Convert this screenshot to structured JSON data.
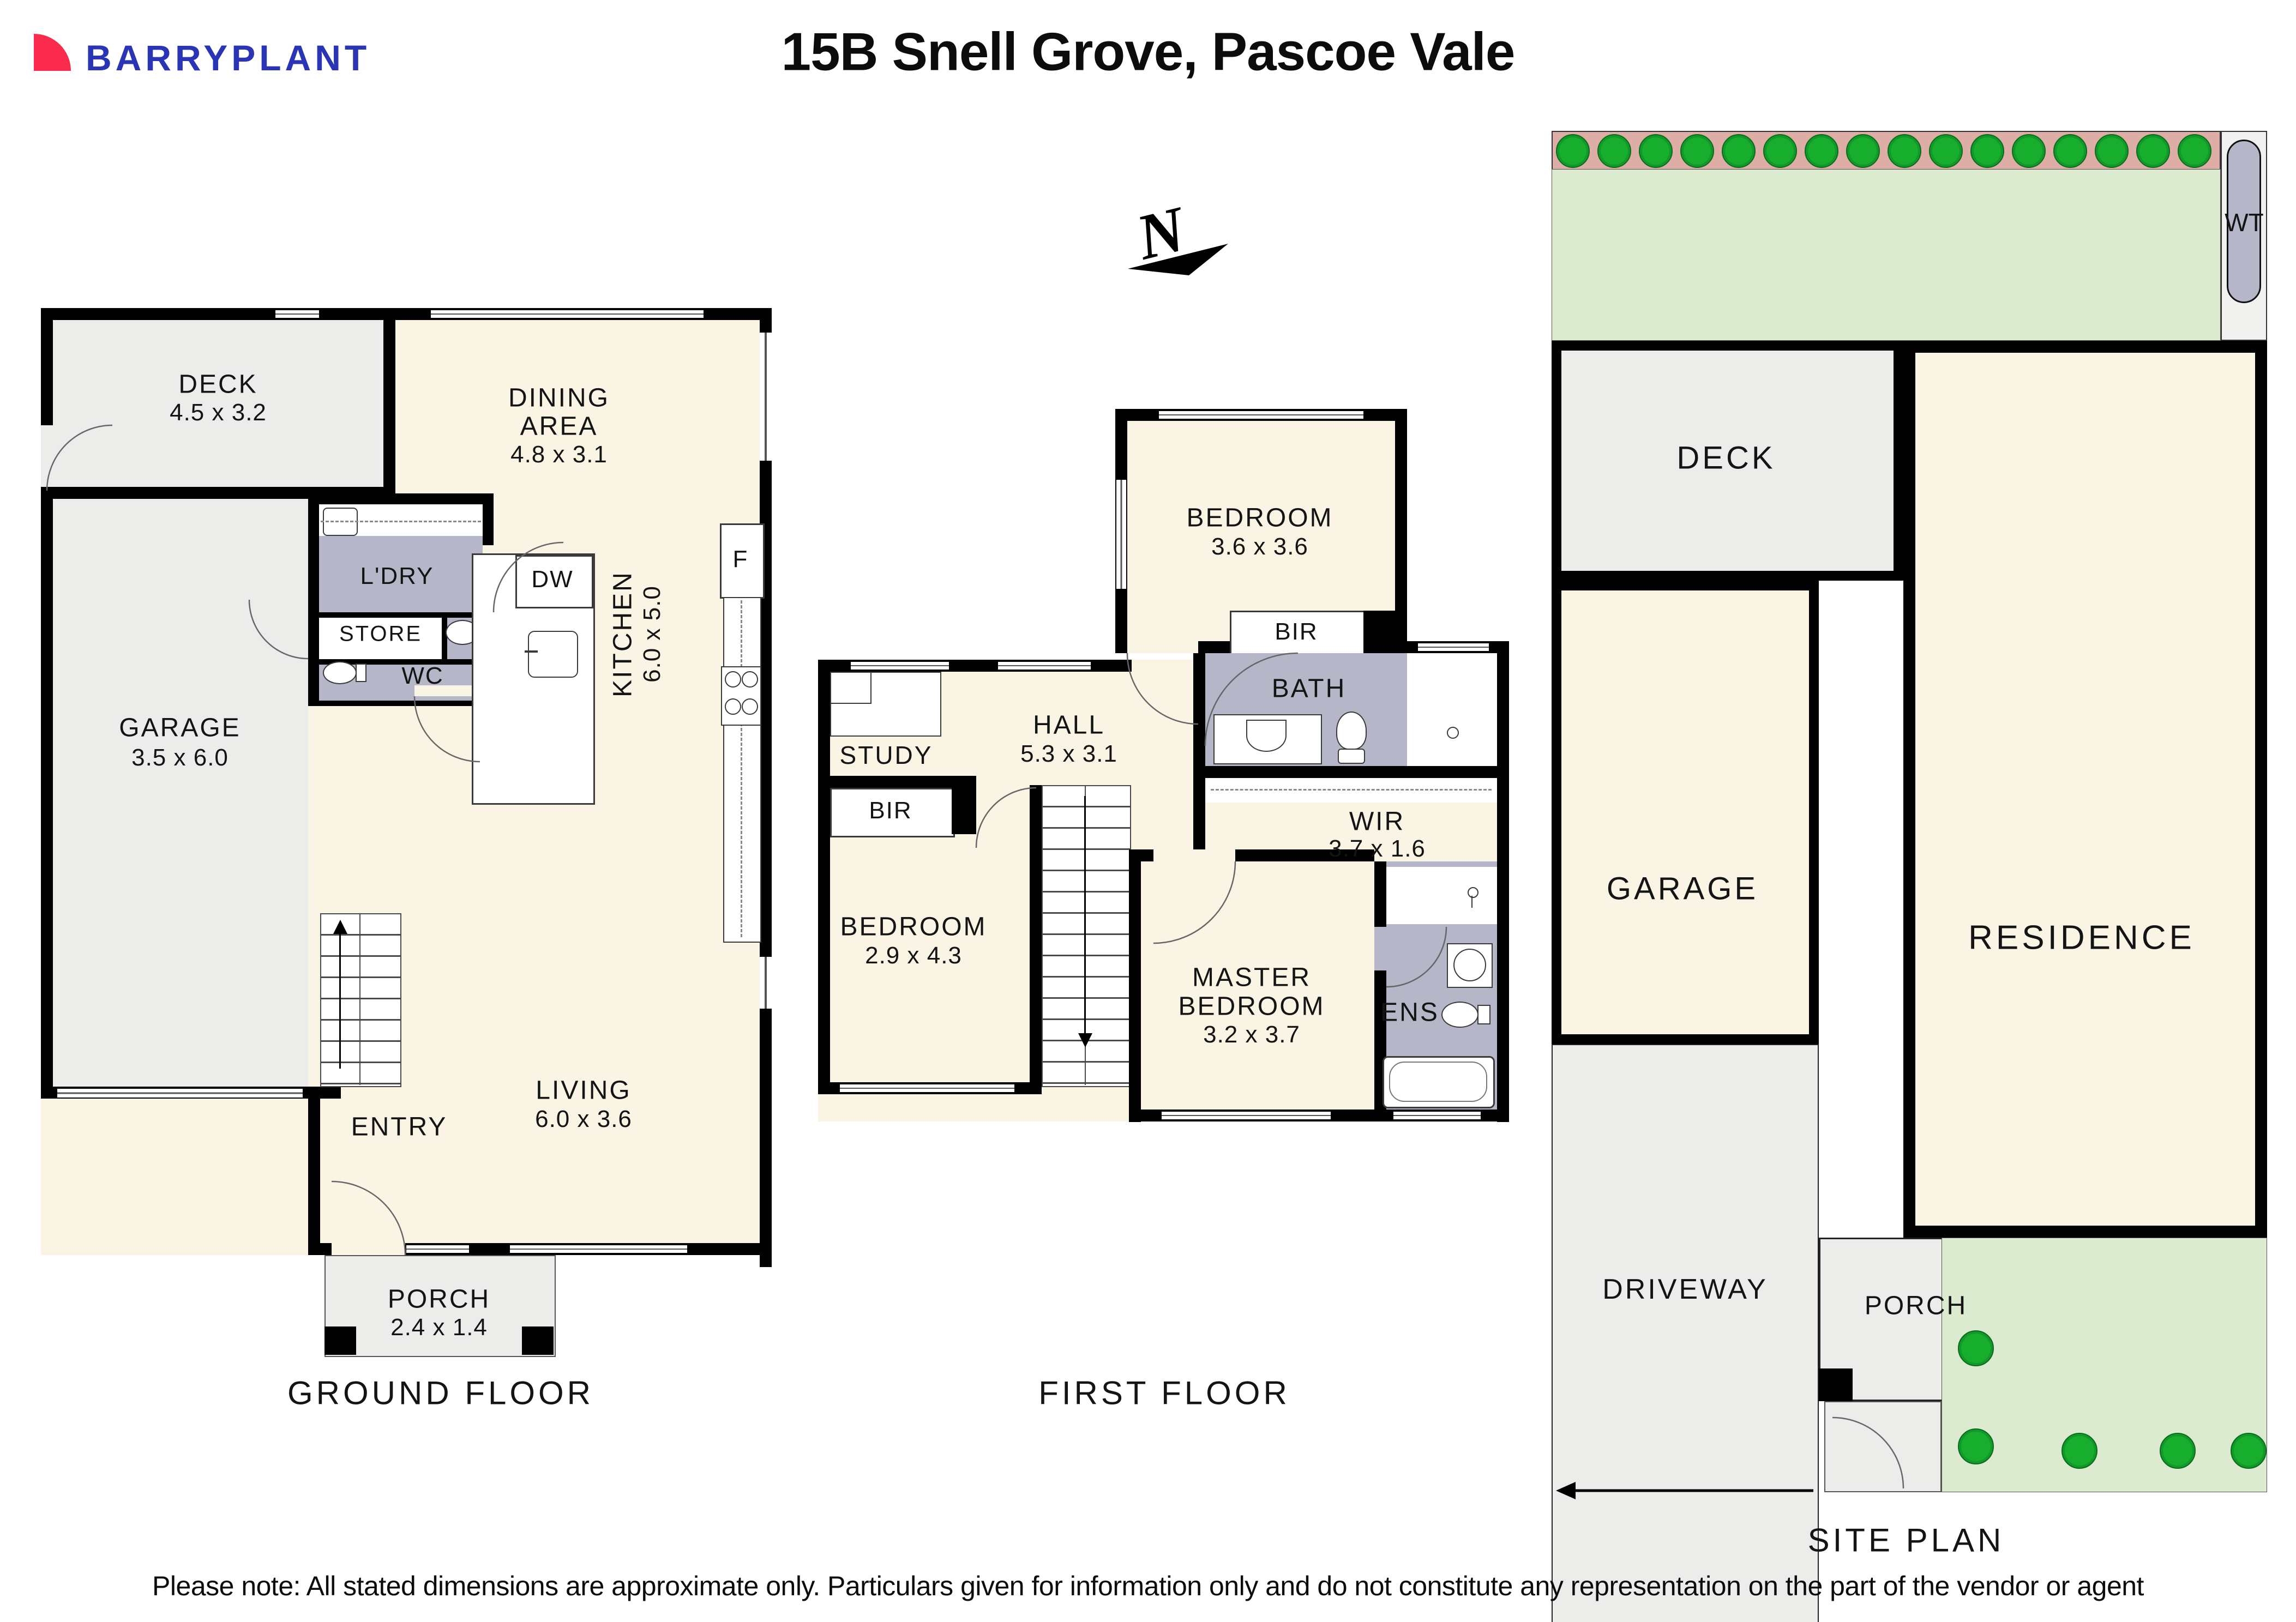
{
  "header": {
    "brand": "BARRYPLANT",
    "title": "15B Snell Grove, Pascoe Vale"
  },
  "compass": {
    "north_label": "N"
  },
  "ground_floor": {
    "title": "GROUND FLOOR",
    "deck": {
      "name": "DECK",
      "dims": "4.5 x 3.2"
    },
    "dining": {
      "line1": "DINING",
      "line2": "AREA",
      "dims": "4.8 x 3.1"
    },
    "garage": {
      "name": "GARAGE",
      "dims": "3.5 x 6.0"
    },
    "laundry": {
      "name": "L'DRY"
    },
    "store": {
      "name": "STORE"
    },
    "wc": {
      "name": "WC"
    },
    "kitchen": {
      "name": "KITCHEN",
      "dims": "6.0 x 5.0"
    },
    "living": {
      "name": "LIVING",
      "dims": "6.0 x 3.6"
    },
    "entry": {
      "name": "ENTRY"
    },
    "porch": {
      "name": "PORCH",
      "dims": "2.4 x 1.4"
    },
    "fridge_label": "F",
    "dishwasher_label": "DW"
  },
  "first_floor": {
    "title": "FIRST FLOOR",
    "bedroom2": {
      "name": "BEDROOM",
      "dims": "3.6 x 3.6"
    },
    "bedroom2_robe": "BIR",
    "bath": {
      "name": "BATH"
    },
    "study": {
      "name": "STUDY"
    },
    "hall": {
      "name": "HALL",
      "dims": "5.3 x 3.1"
    },
    "wir": {
      "name": "WIR",
      "dims": "3.7 x 1.6"
    },
    "bedroom3": {
      "name": "BEDROOM",
      "dims": "2.9 x 4.3"
    },
    "bedroom3_robe": "BIR",
    "master": {
      "line1": "MASTER",
      "line2": "BEDROOM",
      "dims": "3.2 x 3.7"
    },
    "ensuite": {
      "name": "ENS"
    }
  },
  "site_plan": {
    "title": "SITE PLAN",
    "deck": "DECK",
    "residence": "RESIDENCE",
    "garage": "GARAGE",
    "driveway": "DRIVEWAY",
    "porch": "PORCH",
    "water_tank": "WT"
  },
  "footer": {
    "disclaimer": "Please note: All stated dimensions are approximate only. Particulars given for information only and do not constitute any representation on the part of the vendor or agent"
  },
  "colors": {
    "room_fill": "#FAF4E4",
    "outdoor_grey": "#ECECEA",
    "wet_area": "#B5B7C9",
    "lawn": "#DCEACF",
    "garden_bed": "#DCAEA6",
    "tree": "#17AD2D",
    "brand_red": "#FB2B4E",
    "brand_blue": "#2A35B5",
    "wall": "#000000"
  }
}
